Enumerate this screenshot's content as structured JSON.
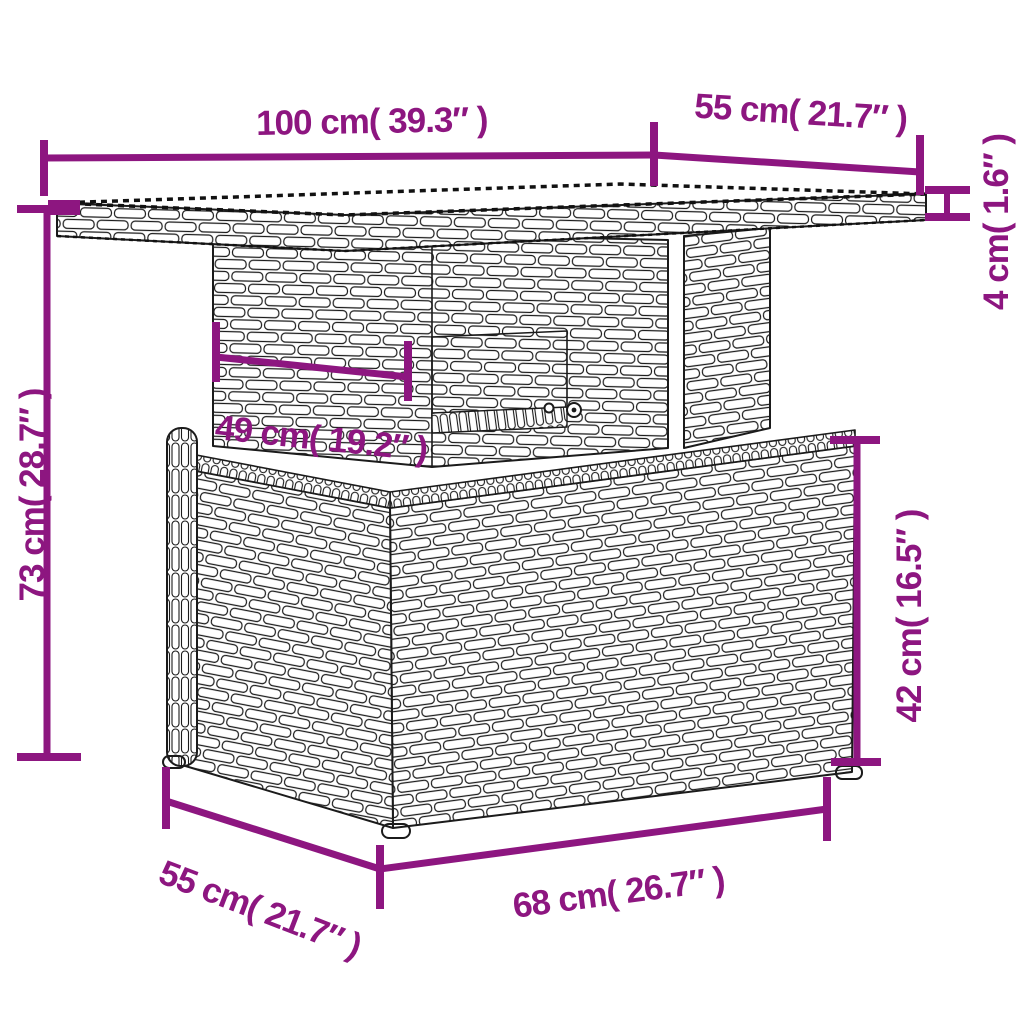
{
  "canvas": {
    "background": "#ffffff",
    "accent_color": "#8D1680",
    "line_art_color": "#1b1b1b",
    "tabletop_surface_color": "#9c9c9c"
  },
  "diagram": {
    "dimensions": {
      "tabletop_width": "100 cm( 39.3″ )",
      "tabletop_depth": "55 cm( 21.7″ )",
      "tabletop_thickness": "4 cm( 1.6″ )",
      "total_height": "73 cm( 28.7″ )",
      "undertop_width": "49 cm( 19.2″ )",
      "base_height": "42 cm( 16.5″ )",
      "base_depth": "55 cm( 21.7″ )",
      "base_width": "68 cm( 26.7″ )"
    }
  }
}
